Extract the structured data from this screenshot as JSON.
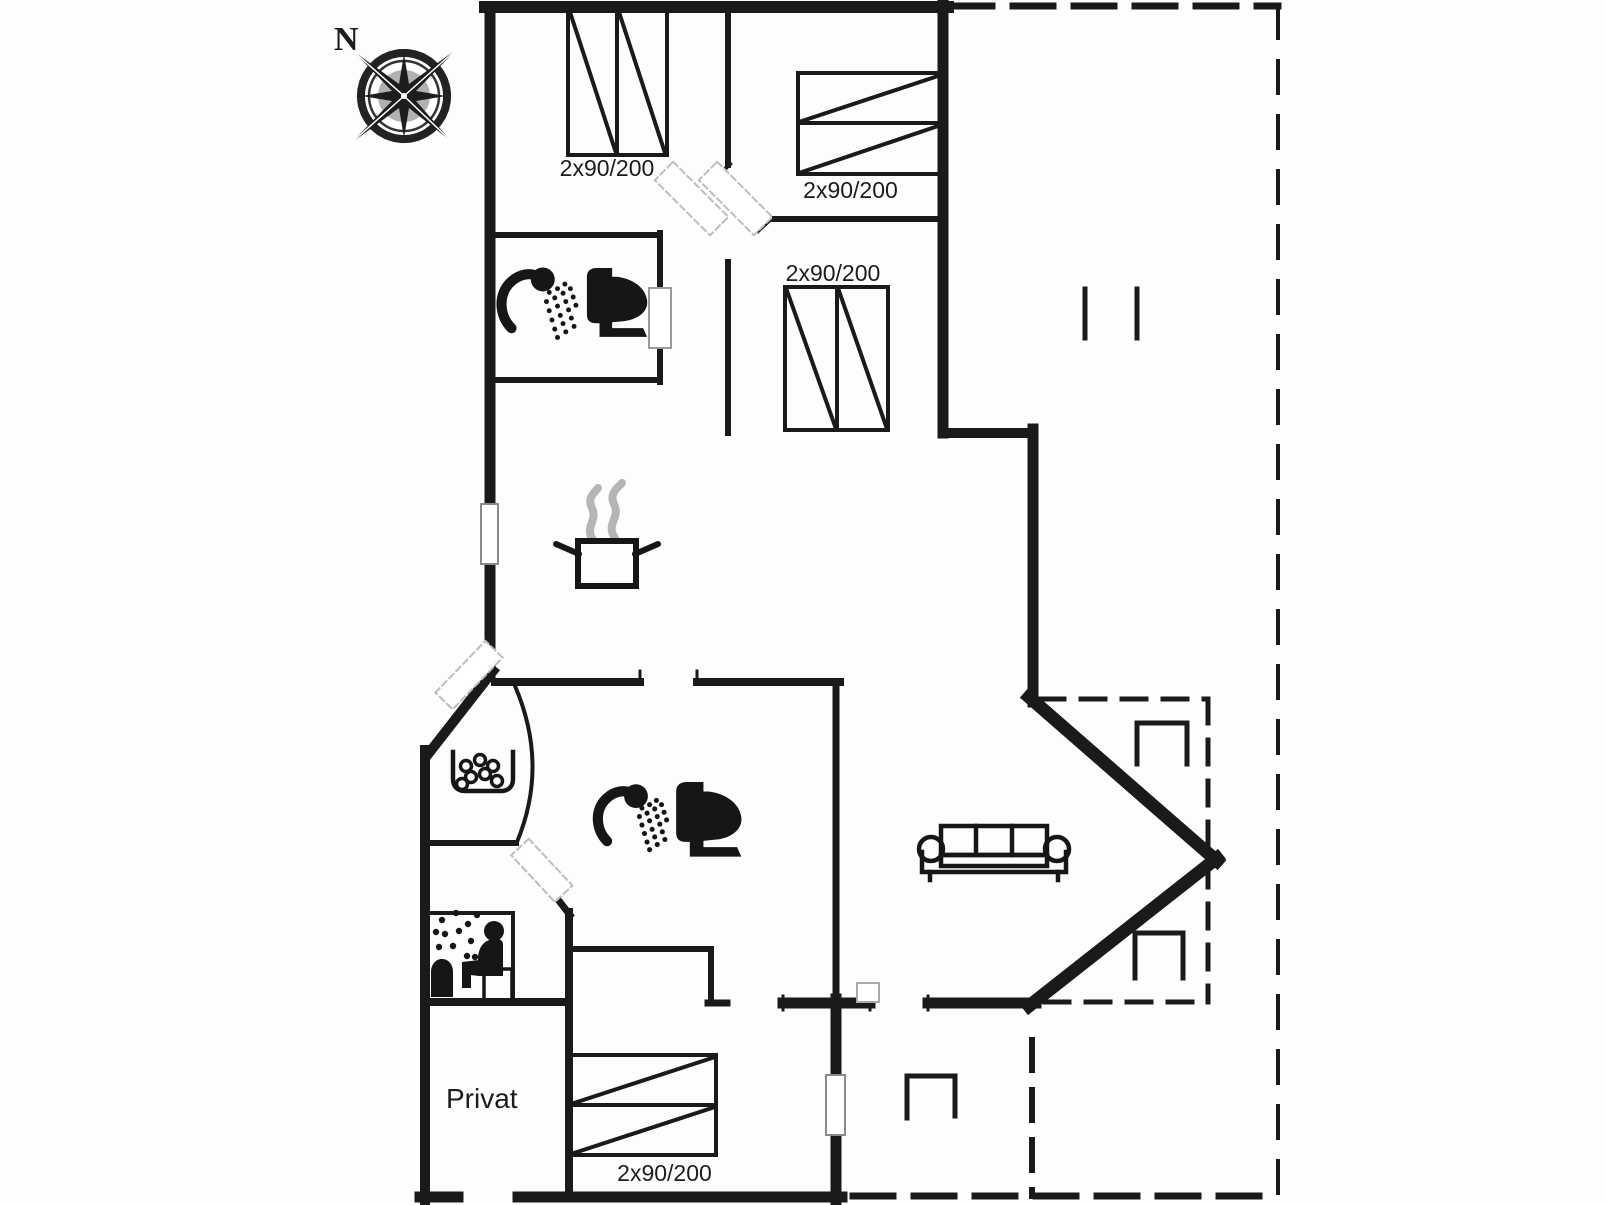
{
  "compass": {
    "north_label": "N"
  },
  "beds": {
    "top_left_label": "2x90/200",
    "top_right_label": "2x90/200",
    "middle_label": "2x90/200",
    "bottom_label": "2x90/200"
  },
  "rooms": {
    "private_label": "Privat"
  },
  "icons": {
    "compass-rose": "eight-point-star-with-tick-ring",
    "double-bed": "rect-with-diagonals",
    "shower": "hand-shower-with-spray-dots",
    "toilet": "black-toilet-silhouette",
    "cooking-pot": "pot-with-steam",
    "steam": "grey-wisps",
    "washbasin": "bowl-with-bubbles",
    "sauna": "person-on-bench-with-heater",
    "sofa": "three-seat-outline",
    "terrace-chair": "open-square",
    "terrace-bench": "two-short-lines",
    "window": "white-gap-in-wall",
    "door-leaf": "dashed-white-strip"
  },
  "colors": {
    "line": "#1a1a1a",
    "steam": "#b5b5b5",
    "background": "#fdfdfd",
    "door_leaf_border": "#bdbdbd"
  }
}
